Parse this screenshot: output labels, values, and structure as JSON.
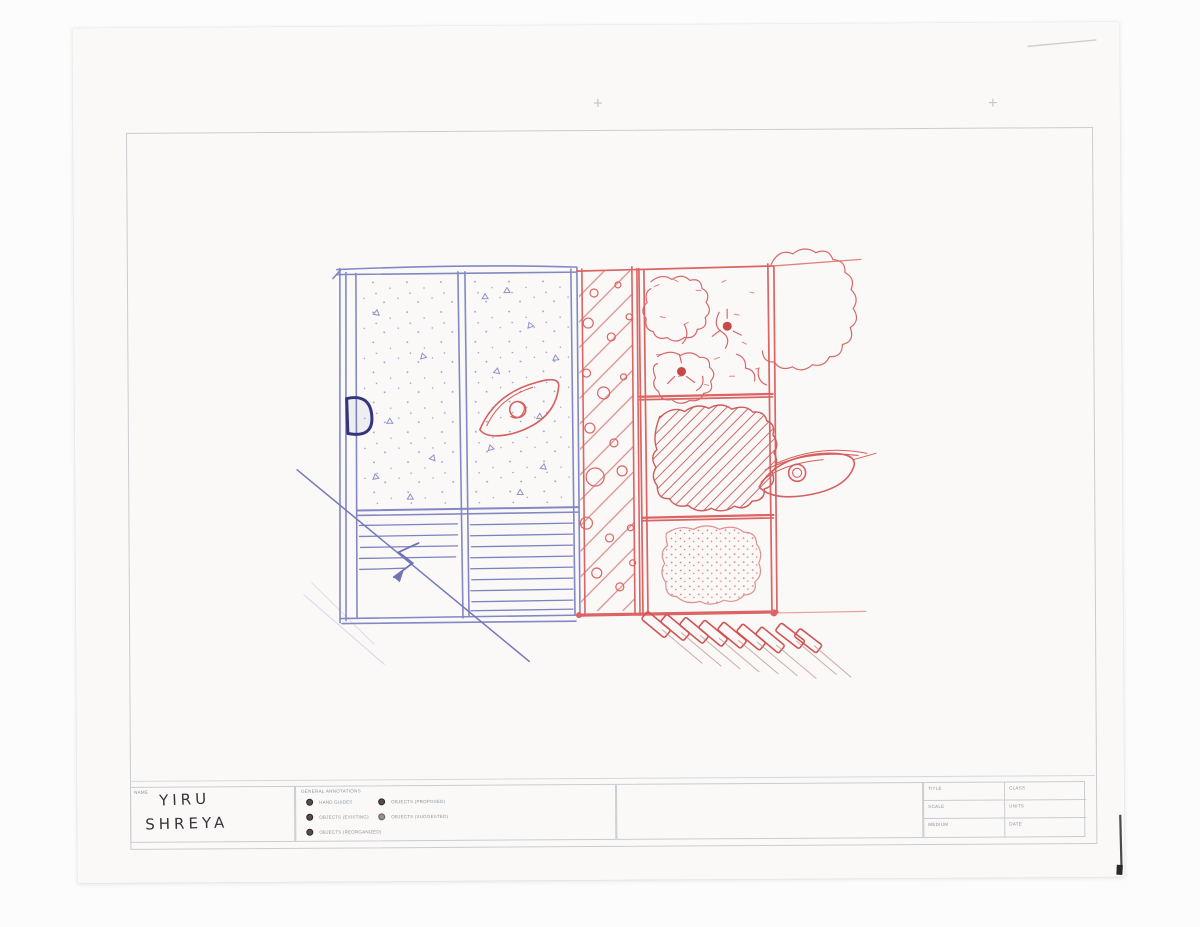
{
  "document": {
    "name_box_label": "NAME",
    "names": [
      "YIRU",
      "SHREYA"
    ]
  },
  "legend": {
    "header": "GENERAL ANNOTATIONS",
    "items_left": [
      "HAND GUIDES",
      "OBJECTS (EXISTING)",
      "OBJECTS (REORGANIZED)"
    ],
    "items_right": [
      "OBJECTS (PROPOSED)",
      "OBJECTS (SUGGESTED)"
    ]
  },
  "title_block": {
    "rows": [
      {
        "left": "TITLE",
        "right": "CLASS"
      },
      {
        "left": "SCALE",
        "right": "UNITS"
      },
      {
        "left": "MEDIUM",
        "right": "DATE"
      }
    ]
  },
  "colors": {
    "blue_pen": "#7d82c0",
    "dark_blue_pen": "#34347e",
    "red_pen": "#db6464",
    "paper": "#faf9f7",
    "template_line": "#c9ccd0",
    "handwriting_ink": "#35353a"
  }
}
